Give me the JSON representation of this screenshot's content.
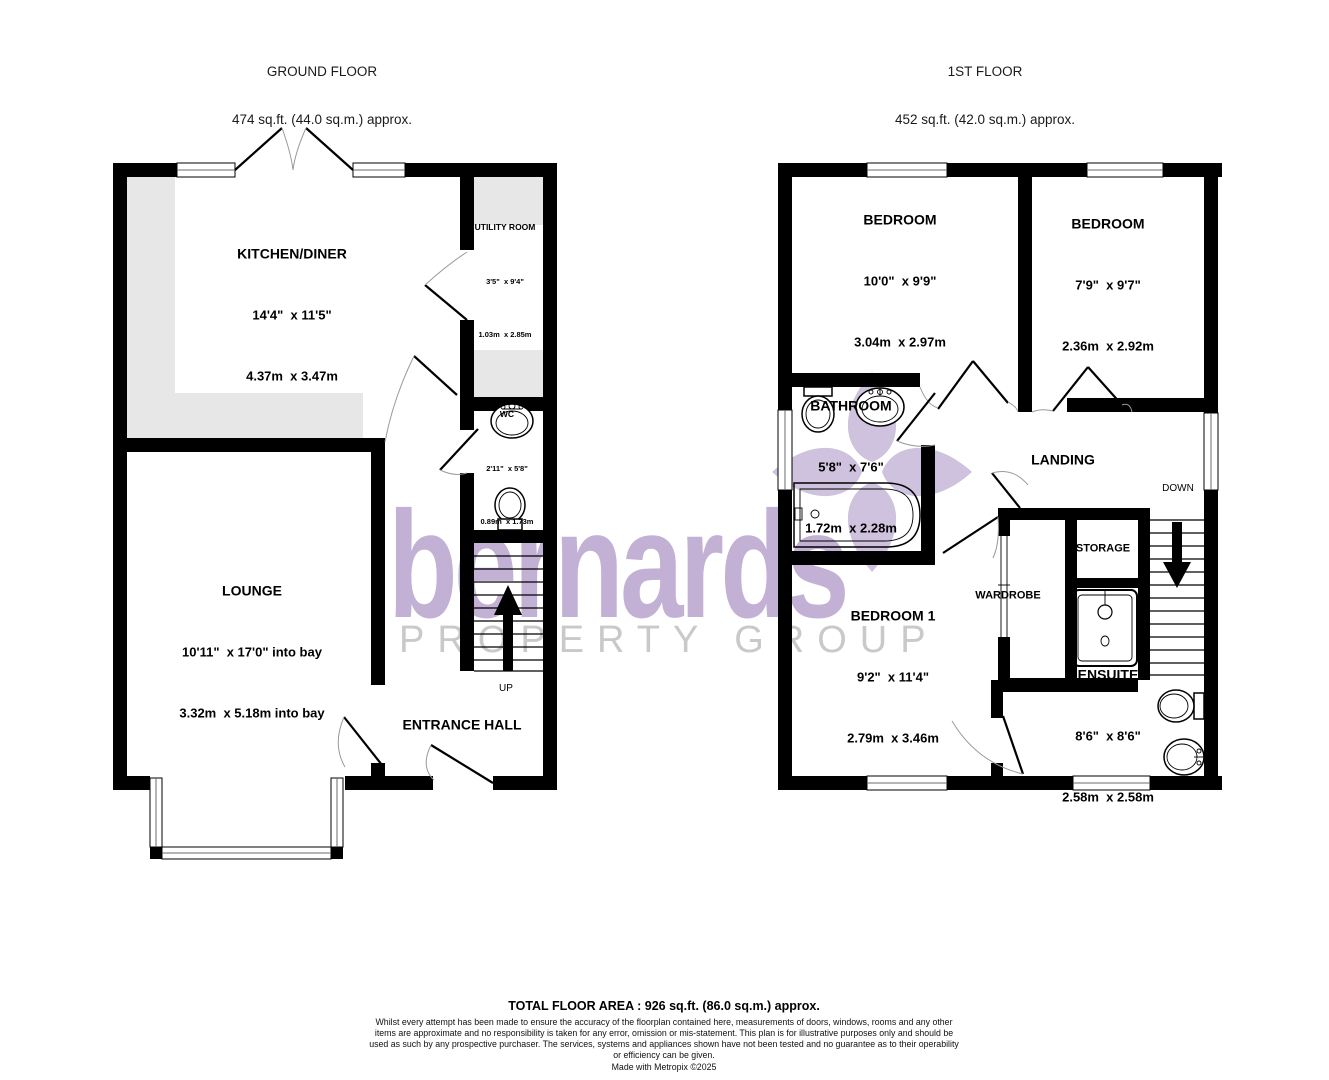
{
  "watermark": {
    "brand": "bernards",
    "tagline": "PROPERTY GROUP",
    "brand_color": "#c2b1d4",
    "tagline_color": "#c9c9c9",
    "flower_color": "#cfc2de"
  },
  "floors": [
    {
      "title": "GROUND FLOOR",
      "area": "474 sq.ft. (44.0 sq.m.) approx.",
      "rooms": {
        "kitchen": {
          "name": "KITCHEN/DINER",
          "imperial": "14'4\"  x 11'5\"",
          "metric": "4.37m  x 3.47m"
        },
        "utility": {
          "name": "UTILITY ROOM",
          "imperial": "3'5\"  x 9'4\"",
          "metric": "1.03m  x 2.85m"
        },
        "wc": {
          "name": "WC",
          "imperial": "2'11\"  x 5'8\"",
          "metric": "0.89m  x 1.73m"
        },
        "lounge": {
          "name": "LOUNGE",
          "imperial": "10'11\"  x 17'0\" into bay",
          "metric": "3.32m  x 5.18m into bay"
        },
        "entrance_hall": {
          "name": "ENTRANCE HALL"
        },
        "stairs": {
          "label": "UP"
        }
      }
    },
    {
      "title": "1ST FLOOR",
      "area": "452 sq.ft. (42.0 sq.m.) approx.",
      "rooms": {
        "bedroom_a": {
          "name": "BEDROOM",
          "imperial": "10'0\"  x 9'9\"",
          "metric": "3.04m  x 2.97m"
        },
        "bedroom_b": {
          "name": "BEDROOM",
          "imperial": "7'9\"  x 9'7\"",
          "metric": "2.36m  x 2.92m"
        },
        "bathroom": {
          "name": "BATHROOM",
          "imperial": "5'8\"  x 7'6\"",
          "metric": "1.72m  x 2.28m"
        },
        "landing": {
          "name": "LANDING"
        },
        "storage": {
          "name": "STORAGE"
        },
        "wardrobe": {
          "name": "WARDROBE"
        },
        "bedroom_1": {
          "name": "BEDROOM 1",
          "imperial": "9'2\"  x 11'4\"",
          "metric": "2.79m  x 3.46m"
        },
        "ensuite": {
          "name": "ENSUITE",
          "imperial": "8'6\"  x 8'6\"",
          "metric": "2.58m  x 2.58m"
        },
        "stairs": {
          "label": "DOWN"
        }
      }
    }
  ],
  "footer": {
    "total_area": "TOTAL FLOOR AREA : 926 sq.ft. (86.0 sq.m.) approx.",
    "disclaimer": "Whilst every attempt has been made to ensure the accuracy of the floorplan contained here, measurements of doors, windows, rooms and any other items are approximate and no responsibility is taken for any error, omission or mis-statement. This plan is for illustrative purposes only and should be used as such by any prospective purchaser. The services, systems and appliances shown have not been tested and no guarantee as to their operability or efficiency can be given.",
    "credit": "Made with Metropix ©2025"
  }
}
